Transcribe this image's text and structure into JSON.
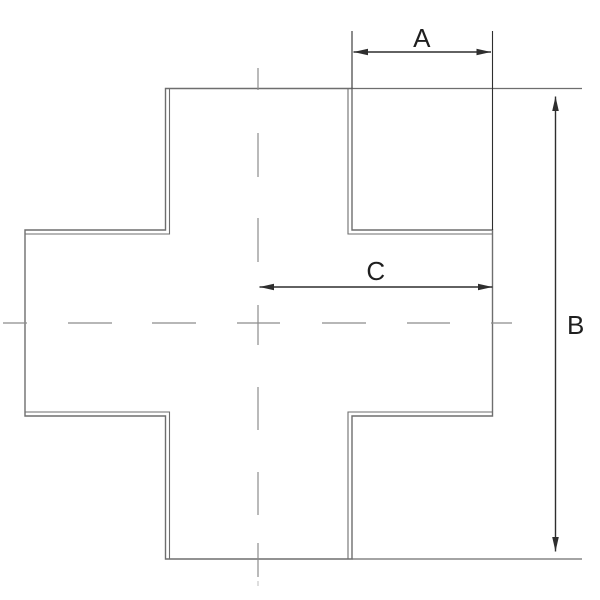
{
  "drawing": {
    "type": "technical-dimension-drawing",
    "subject": "equal-cross-fitting-outline",
    "dimensions": {
      "a": {
        "label": "A",
        "orientation": "horizontal",
        "location": "top-right"
      },
      "b": {
        "label": "B",
        "orientation": "vertical",
        "location": "right"
      },
      "c": {
        "label": "C",
        "orientation": "horizontal",
        "location": "center-right"
      }
    }
  },
  "colors": {
    "background": "#ffffff",
    "outline": "#6e6e6e",
    "centerline": "#8c8c8c",
    "dimension": "#2e2e2e",
    "text": "#1f1f1f"
  }
}
